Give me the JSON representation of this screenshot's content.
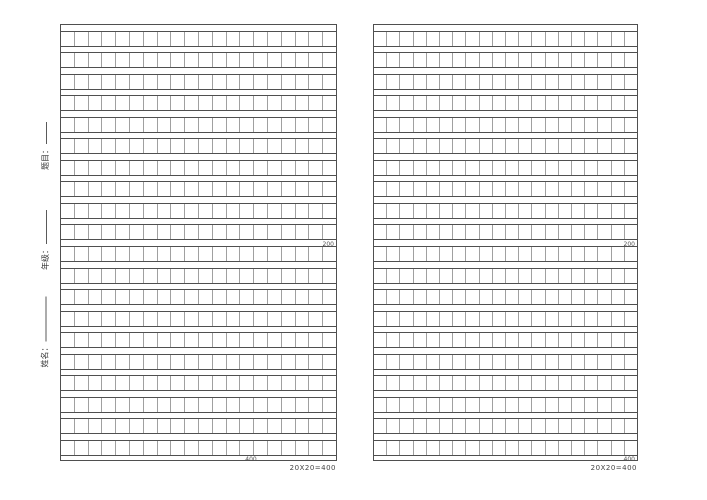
{
  "grid": {
    "rows": 20,
    "cols": 20
  },
  "sidebar": {
    "fields": [
      {
        "id": "title",
        "label": "题目："
      },
      {
        "id": "grade",
        "label": "年级："
      },
      {
        "id": "name",
        "label": "姓名："
      }
    ]
  },
  "pages": [
    {
      "mid_marker": "200",
      "end_marker": "400",
      "caption": "20X20=400"
    },
    {
      "mid_marker": "200",
      "end_marker": "400",
      "caption": "20X20=400"
    }
  ],
  "colors": {
    "line_dark": "#4f4f4f",
    "line_light": "#a0a0a0",
    "paper": "#ffffff",
    "marker_text": "#555555"
  }
}
